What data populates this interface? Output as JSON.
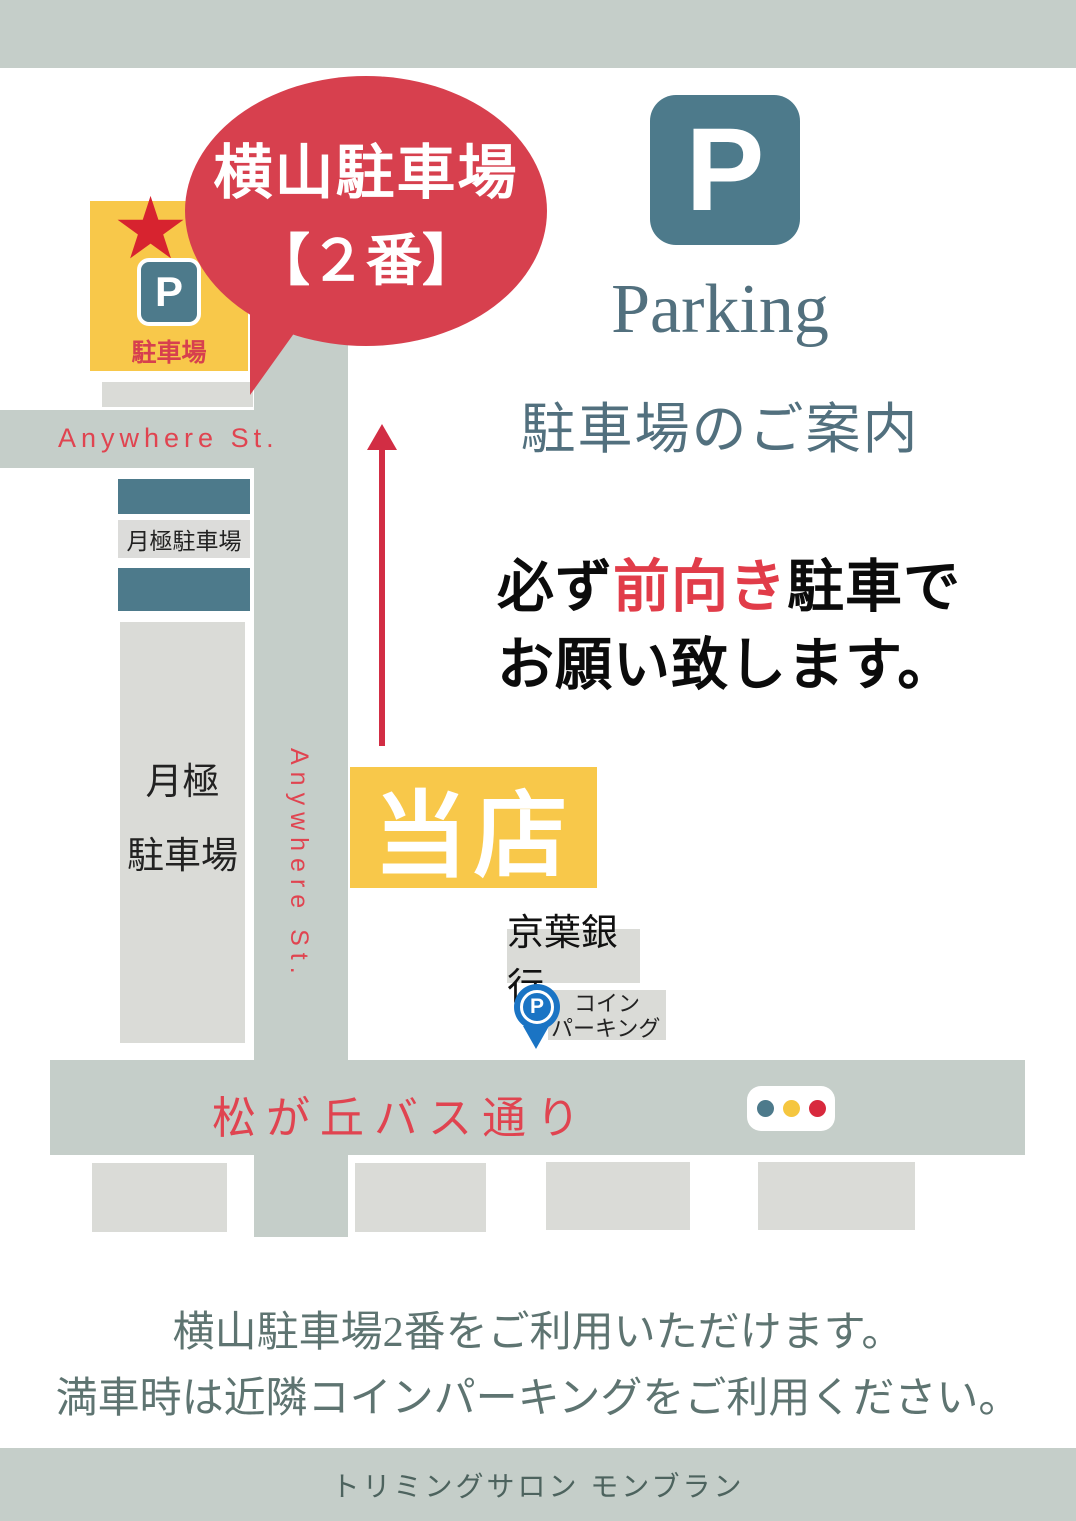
{
  "header": {
    "p": "P",
    "title_en": "Parking",
    "title_ja": "駐車場のご案内"
  },
  "bubble": {
    "line1": "横山駐車場",
    "line2": "【２番】"
  },
  "lot_sign": {
    "p": "P",
    "label": "駐車場"
  },
  "icons": {
    "star": "★"
  },
  "streets": {
    "anywhere_horizontal": "Anywhere St.",
    "anywhere_vertical": "Anywhere St.",
    "bus_street": "松が丘バス通り"
  },
  "monthly_parking": {
    "small_label": "月極駐車場",
    "big_line1": "月極",
    "big_line2": "駐車場"
  },
  "notice": {
    "line1_pre": "必ず",
    "line1_highlight": "前向き",
    "line1_post": "駐車で",
    "line2": "お願い致します。"
  },
  "shop": {
    "label": "当店"
  },
  "bank": {
    "label": "京葉銀行"
  },
  "coin_parking": {
    "p": "P",
    "line1": "コイン",
    "line2": "パーキング"
  },
  "usage_note": {
    "line1": "横山駐車場2番をご利用いただけます。",
    "line2": "満車時は近隣コインパーキングをご利用ください。"
  },
  "footer": {
    "shop_name": "トリミングサロン モンブラン"
  },
  "colors": {
    "sage": "#c5cec9",
    "gray": "#dadbd7",
    "teal": "#4d7a8b",
    "yellow": "#f8c84a",
    "red": "#d7404e",
    "red_dark": "#d22d44",
    "red_text": "#e04450",
    "blue": "#1a74c4",
    "header_text": "#52707e",
    "note_text": "#5e7471",
    "footer_text": "#4d635e"
  }
}
